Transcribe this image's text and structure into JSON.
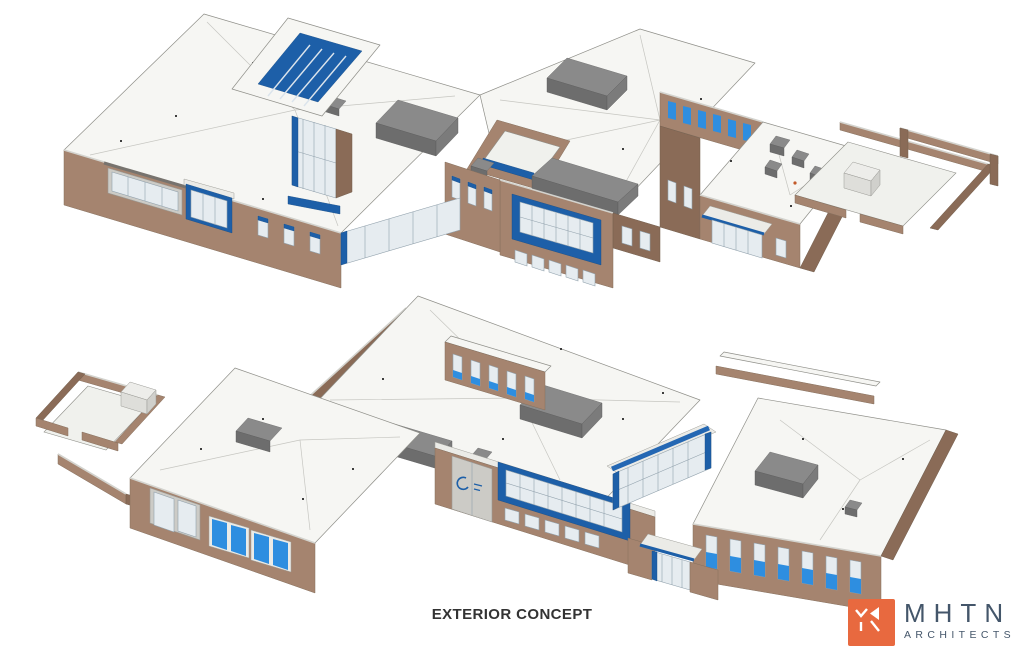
{
  "caption": {
    "text": "EXTERIOR CONCEPT"
  },
  "logo": {
    "name": "MHTN",
    "subname": "ARCHITECTS",
    "icon": "mhtn-monogram-icon"
  },
  "views": [
    {
      "label": "upper-exterior-axonometric-view"
    },
    {
      "label": "lower-exterior-axonometric-view"
    }
  ],
  "palette": {
    "background": "#ffffff",
    "wall": "#a5846f",
    "wall-dark": "#8a6b57",
    "roof": "#f6f6f3",
    "roof-edge": "#8f8f89",
    "roof-line": "#c6c6c1",
    "courtyard-floor": "#f0f1ed",
    "glass": "#e6ecf0",
    "mullion": "#92a2ad",
    "accent-blue": "#1d5fa8",
    "window-blue": "#2e8ee0",
    "rtu": "#8a8a8a",
    "rtu-dark": "#6d6d6d",
    "rtu-side": "#7b7b7b",
    "caption-color": "#333333",
    "logo-orange": "#e8693f",
    "logo-text": "#44566a"
  }
}
